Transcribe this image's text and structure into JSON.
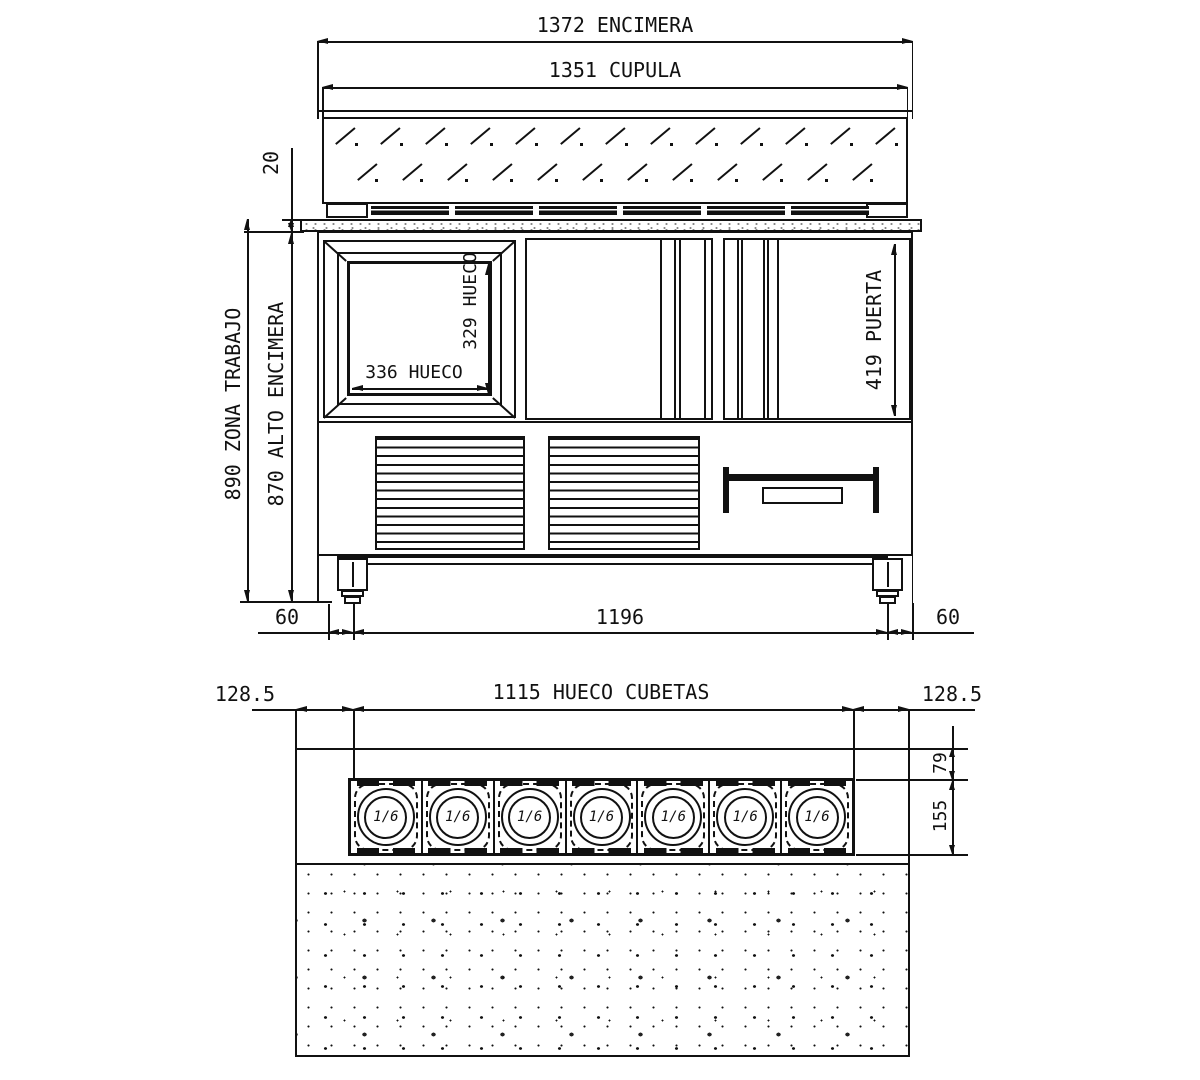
{
  "front_view": {
    "dim_encimera": "1372 ENCIMERA",
    "dim_cupula": "1351 CUPULA",
    "dim_top_thickness": "20",
    "dim_zona_trabajo": "890 ZONA TRABAJO",
    "dim_alto_encimera": "870 ALTO ENCIMERA",
    "dim_hueco_width": "336 HUECO",
    "dim_hueco_height": "329 HUECO",
    "dim_puerta": "419 PUERTA",
    "dim_left_offset": "60",
    "dim_base_width": "1196",
    "dim_right_offset": "60"
  },
  "plan_view": {
    "dim_left_margin": "128.5",
    "dim_hueco_cubetas": "1115 HUECO CUBETAS",
    "dim_right_margin": "128.5",
    "dim_back_offset": "79",
    "dim_row_depth": "155",
    "pans": [
      {
        "label": "1/6"
      },
      {
        "label": "1/6"
      },
      {
        "label": "1/6"
      },
      {
        "label": "1/6"
      },
      {
        "label": "1/6"
      },
      {
        "label": "1/6"
      },
      {
        "label": "1/6"
      }
    ]
  },
  "colors": {
    "line": "#111111",
    "background": "#ffffff"
  }
}
